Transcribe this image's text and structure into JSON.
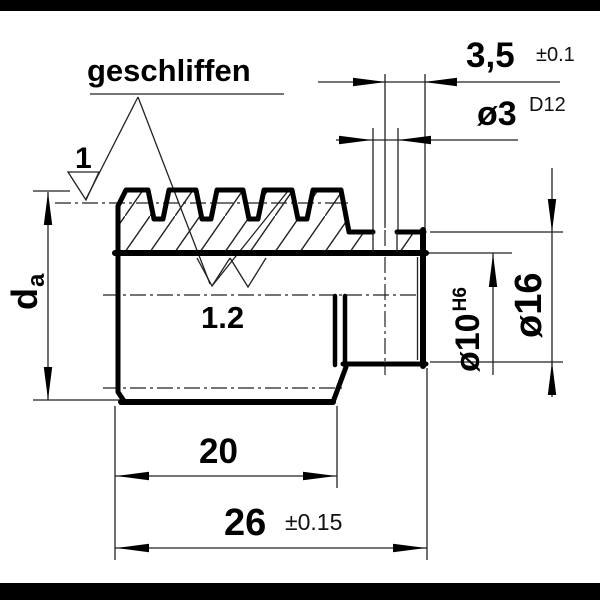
{
  "colors": {
    "ink": "#000000",
    "paper": "#ffffff"
  },
  "annotations": {
    "surface_label": "geschliffen",
    "mark_left_value": "1",
    "mark_flank_value": "1.2"
  },
  "dims": {
    "thread_len": "20",
    "total_len": "26",
    "total_tol": "±0.15",
    "hole_pos": "3,5",
    "hole_pos_tol": "±0.1",
    "hole_dia": "ø3",
    "hole_fit": "D12",
    "bore_dia": "ø10",
    "bore_fit": "H6",
    "boss_dia": "ø16",
    "od_main": "d",
    "od_sub": "a"
  }
}
